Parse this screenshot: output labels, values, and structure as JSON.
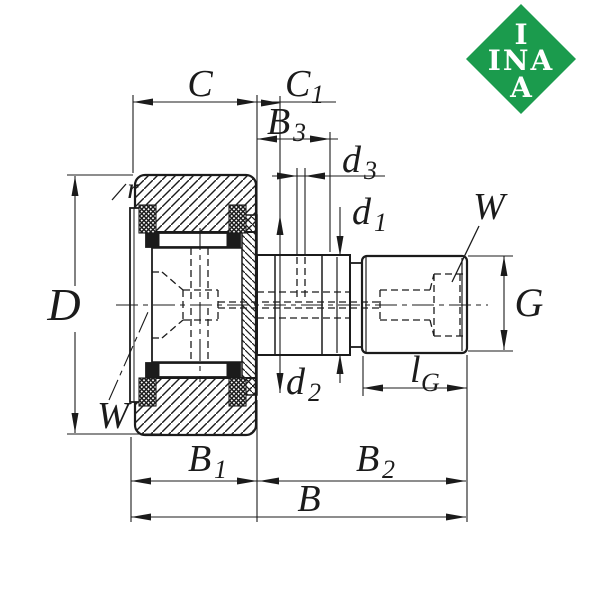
{
  "logo": {
    "top": "I",
    "middle": "INA",
    "bottom": "A",
    "color": "#1b9b4d"
  },
  "colors": {
    "line": "#1b1b1b",
    "background": "#ffffff"
  },
  "labels": {
    "D": {
      "base": "D"
    },
    "C": {
      "base": "C"
    },
    "C1": {
      "base": "C",
      "sub": "1"
    },
    "B3": {
      "base": "B",
      "sub": "3"
    },
    "d3": {
      "base": "d",
      "sub": "3"
    },
    "d1": {
      "base": "d",
      "sub": "1"
    },
    "d2": {
      "base": "d",
      "sub": "2"
    },
    "G": {
      "base": "G"
    },
    "lG": {
      "base": "l",
      "sub": "G"
    },
    "W_right": {
      "base": "W"
    },
    "W_left": {
      "base": "W"
    },
    "r": {
      "base": "r"
    },
    "B1": {
      "base": "B",
      "sub": "1"
    },
    "B2": {
      "base": "B",
      "sub": "2"
    },
    "B": {
      "base": "B"
    }
  }
}
